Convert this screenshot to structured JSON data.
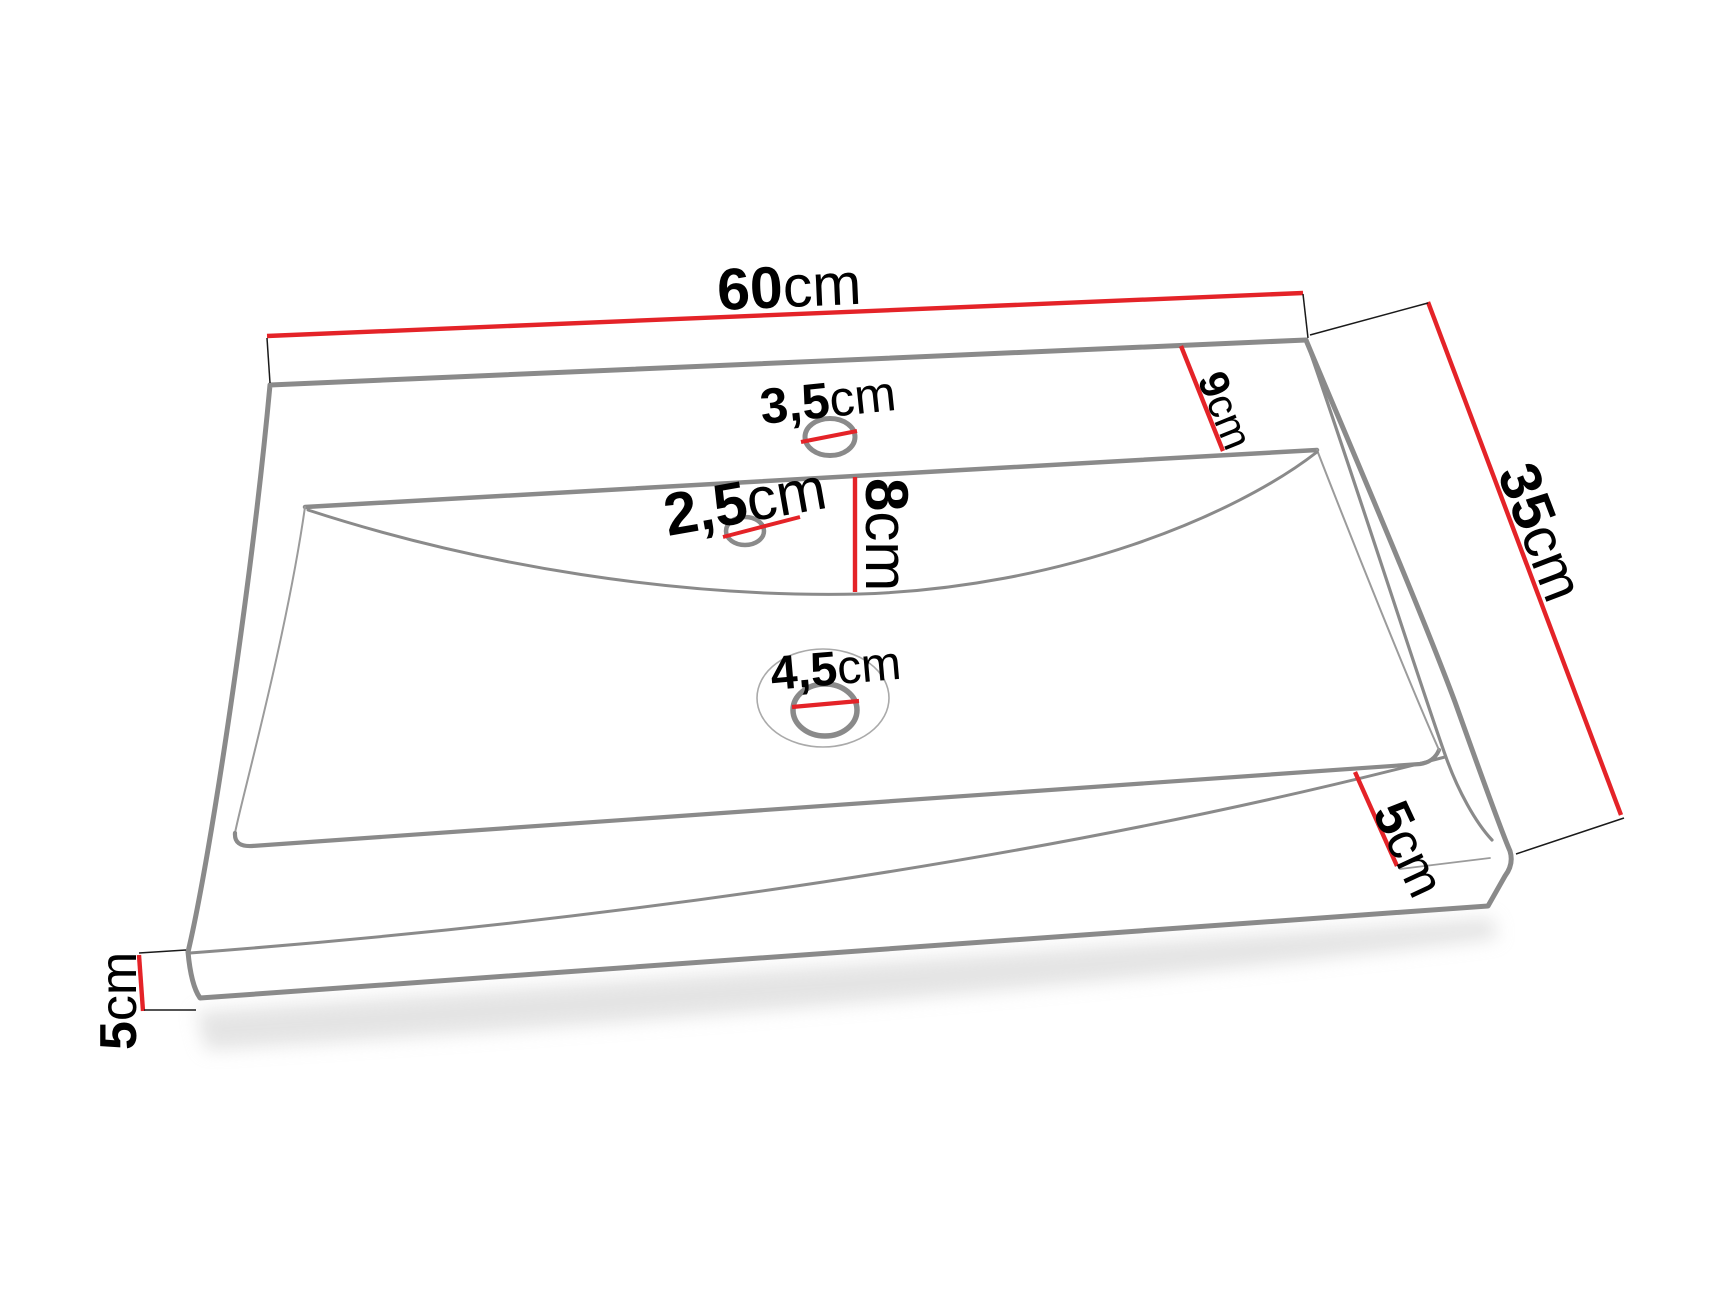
{
  "diagram": {
    "type": "technical-dimension-drawing",
    "subject": "ceramic washbasin perspective view with measurements",
    "background": "#ffffff",
    "colors": {
      "dimension_red": "#e42328",
      "outline_gray": "#8a8a8a",
      "text_black": "#000000"
    },
    "labels": {
      "width": {
        "value": "60",
        "unit": "cm"
      },
      "depth": {
        "value": "35",
        "unit": "cm"
      },
      "back_rim": {
        "value": "9",
        "unit": "cm"
      },
      "faucet_hole": {
        "value": "3,5",
        "unit": "cm"
      },
      "overflow_hole": {
        "value": "2,5",
        "unit": "cm"
      },
      "basin_front_depth": {
        "value": "8",
        "unit": "cm"
      },
      "drain_hole": {
        "value": "4,5",
        "unit": "cm"
      },
      "right_edge_height": {
        "value": "5",
        "unit": "cm"
      },
      "left_edge_height": {
        "value": "5",
        "unit": "cm"
      }
    }
  }
}
